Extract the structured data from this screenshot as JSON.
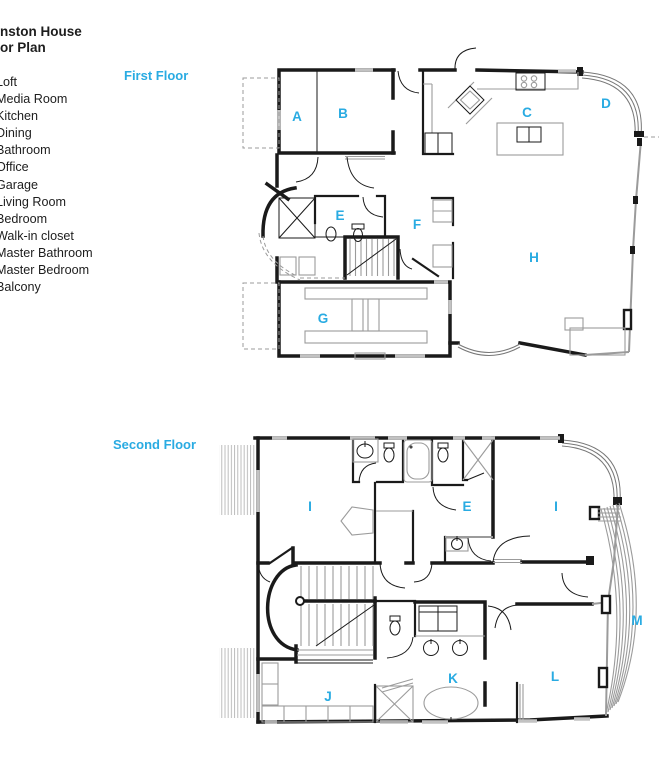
{
  "title": {
    "line1": "nston House",
    "line2": "or Plan"
  },
  "legend": {
    "items": [
      "Loft",
      "Media Room",
      "Kitchen",
      "Dining",
      "Bathroom",
      "Office",
      "Garage",
      "Living Room",
      "Bedroom",
      "Walk-in closet",
      "Master Bathroom",
      "Master Bedroom",
      "Balcony"
    ]
  },
  "floors": {
    "first": {
      "label": "First Floor",
      "rooms": [
        {
          "letter": "A"
        },
        {
          "letter": "B"
        },
        {
          "letter": "C"
        },
        {
          "letter": "D"
        },
        {
          "letter": "E"
        },
        {
          "letter": "F"
        },
        {
          "letter": "G"
        },
        {
          "letter": "H"
        }
      ]
    },
    "second": {
      "label": "Second Floor",
      "rooms": [
        {
          "letter": "I"
        },
        {
          "letter": "E"
        },
        {
          "letter": "I"
        },
        {
          "letter": "M"
        },
        {
          "letter": "J"
        },
        {
          "letter": "K"
        },
        {
          "letter": "L"
        }
      ]
    }
  },
  "colors": {
    "accent": "#29abe2",
    "wall": "#1a1a1a",
    "fixture": "#999999",
    "window": "#b9b9b9"
  }
}
